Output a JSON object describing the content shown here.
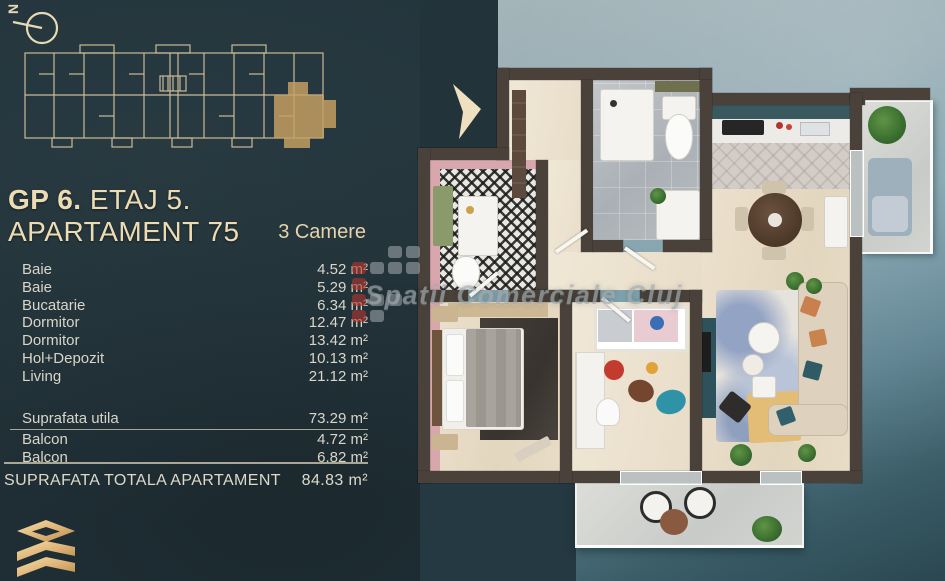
{
  "header": {
    "title_bold": "GP 6.",
    "title_rest": " ETAJ 5. APARTAMENT 75",
    "subtitle": "3 Camere"
  },
  "compass": {
    "letter": "N"
  },
  "rooms": [
    {
      "label": "Baie",
      "value": "4.52 m²"
    },
    {
      "label": "Baie",
      "value": "5.29 m²"
    },
    {
      "label": "Bucatarie",
      "value": "6.34 m²"
    },
    {
      "label": "Dormitor",
      "value": "12.47 m²"
    },
    {
      "label": "Dormitor",
      "value": "13.42 m²"
    },
    {
      "label": "Hol+Depozit",
      "value": "10.13 m²"
    },
    {
      "label": "Living",
      "value": "21.12 m²"
    }
  ],
  "summary": {
    "rows": [
      {
        "label": "Suprafata utila",
        "value": "73.29 m²"
      },
      {
        "label": "Balcon",
        "value": "4.72 m²"
      },
      {
        "label": "Balcon",
        "value": "6.82 m²"
      }
    ],
    "total_label": "SUPRAFATA TOTALA APARTAMENT",
    "total_value": "84.83 m²"
  },
  "watermark": {
    "text": "Spatii Comerciale Cluj"
  },
  "icons": {
    "compass": "compass-north-icon",
    "next_arrow": "chevron-right-icon",
    "brand": "gold-layers-logo"
  },
  "colors": {
    "accent_gold": "#c8a262",
    "cream_text": "#eddcb3",
    "body_text": "#d9d5c8",
    "background_dark": "#22333a",
    "background_light": "#8aa5ae",
    "wall": "#49413a",
    "watermark_red": "#b5352c",
    "highlight_unit": "#c8a262"
  }
}
